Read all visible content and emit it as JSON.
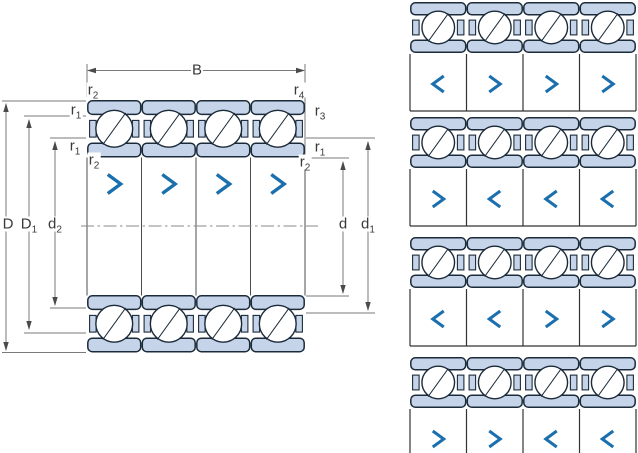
{
  "figure": {
    "kind": "angular-contact-ball-bearing-quad-set-technical-drawing"
  },
  "labels": {
    "B": {
      "base": "B",
      "sub": ""
    },
    "r2_top_left": {
      "base": "r",
      "sub": "2"
    },
    "r4_top_right": {
      "base": "r",
      "sub": "4"
    },
    "r1_left_upper": {
      "base": "r",
      "sub": "1"
    },
    "r3_right": {
      "base": "r",
      "sub": "3"
    },
    "r1_left_lower": {
      "base": "r",
      "sub": "1"
    },
    "r2_left_lower": {
      "base": "r",
      "sub": "2"
    },
    "r1_right": {
      "base": "r",
      "sub": "1"
    },
    "r2_right": {
      "base": "r",
      "sub": "2"
    },
    "D": {
      "base": "D",
      "sub": ""
    },
    "D1": {
      "base": "D",
      "sub": "1"
    },
    "d2": {
      "base": "d",
      "sub": "2"
    },
    "d": {
      "base": "d",
      "sub": ""
    },
    "d1": {
      "base": "d",
      "sub": "1"
    }
  },
  "cross_section": {
    "bearing_count": 4,
    "chevrons": [
      ">",
      ">",
      ">",
      ">"
    ]
  },
  "arrangements": {
    "rows": [
      {
        "chevrons": [
          "<",
          ">",
          ">",
          ">"
        ]
      },
      {
        "chevrons": [
          ">",
          "<",
          "<",
          "<"
        ]
      },
      {
        "chevrons": [
          "<",
          "<",
          ">",
          ">"
        ]
      },
      {
        "chevrons": [
          ">",
          ">",
          "<",
          "<"
        ]
      }
    ]
  },
  "colors": {
    "background": "#ffffff",
    "ring_fill": "#c5d4e9",
    "outline": "#1c2b3a",
    "ball_fill": "#ffffff",
    "chevron_blue": "#1b6fae",
    "dim_line": "#7a7a7a",
    "arrow": "#4a4a4a",
    "centerline": "#8a8a8a",
    "divider": "#333333",
    "label_text": "#3a3a3a"
  }
}
